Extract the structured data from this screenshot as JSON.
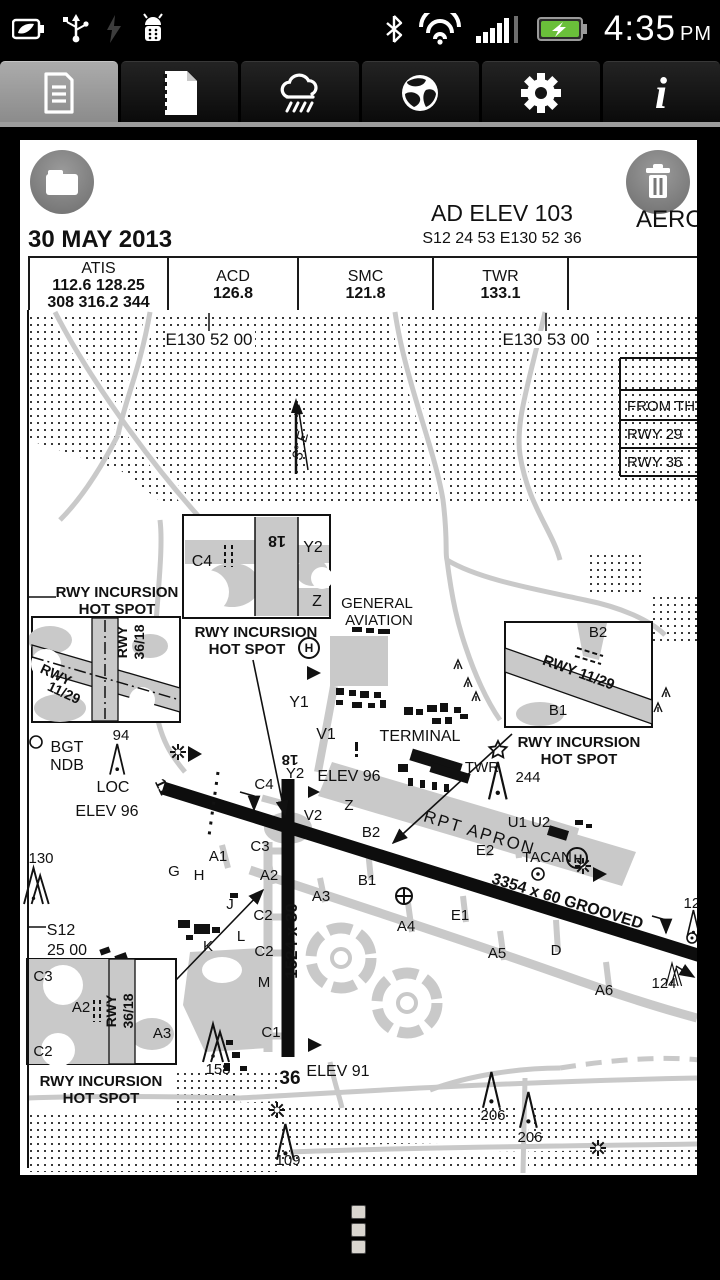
{
  "status_bar": {
    "time": "4:35",
    "meridiem": "PM",
    "left_icons": [
      "battery-saver-leaf-icon",
      "usb-icon",
      "flash-dim-icon",
      "android-debug-icon"
    ],
    "right_icons": [
      "bluetooth-icon",
      "wifi-icon",
      "signal-strength-icon",
      "battery-charging-icon"
    ]
  },
  "tabs": {
    "items": [
      {
        "icon": "document-icon",
        "selected": true
      },
      {
        "icon": "plates-page-icon",
        "selected": false
      },
      {
        "icon": "weather-cloud-icon",
        "selected": false
      },
      {
        "icon": "globe-icon",
        "selected": false
      },
      {
        "icon": "settings-gear-icon",
        "selected": false
      },
      {
        "icon": "info-icon",
        "selected": false
      }
    ]
  },
  "page": {
    "buttons": {
      "folder": "folder-icon",
      "trash": "trash-icon"
    },
    "header": {
      "date": "30 MAY 2013",
      "ad_elev": "AD ELEV 103",
      "ad_coords": "S12 24 53  E130 52 36",
      "title_partial": "AEROD"
    },
    "freq_table": [
      {
        "name": "ATIS",
        "values": [
          "112.6  128.25",
          "308  316.2  344"
        ]
      },
      {
        "name": "ACD",
        "values": [
          "126.8"
        ]
      },
      {
        "name": "SMC",
        "values": [
          "121.8"
        ]
      },
      {
        "name": "TWR",
        "values": [
          "133.1"
        ]
      },
      {
        "name": "",
        "values": []
      }
    ],
    "info_table": {
      "rows": [
        "",
        "FROM TH",
        "RWY 29",
        "RWY 36"
      ]
    },
    "map_labels": [
      {
        "t": "E130 52 00",
        "x": 209,
        "y": 345,
        "s": 17
      },
      {
        "t": "E130 53 00",
        "x": 546,
        "y": 345,
        "s": 17
      },
      {
        "t": "3° E",
        "x": 305,
        "y": 447,
        "s": 15,
        "i": 1,
        "r": -76
      },
      {
        "t": "RWY INCURSION",
        "x": 117,
        "y": 597,
        "s": 15,
        "b": 1
      },
      {
        "t": "HOT SPOT",
        "x": 117,
        "y": 614,
        "s": 15,
        "b": 1
      },
      {
        "t": "RWY INCURSION",
        "x": 256,
        "y": 637,
        "s": 15,
        "b": 1
      },
      {
        "t": "HOT SPOT",
        "x": 247,
        "y": 654,
        "s": 15,
        "b": 1
      },
      {
        "t": "H",
        "x": 309,
        "y": 652,
        "s": 12,
        "b": 1
      },
      {
        "t": "GENERAL",
        "x": 377,
        "y": 608,
        "s": 15
      },
      {
        "t": "AVIATION",
        "x": 379,
        "y": 625,
        "s": 15
      },
      {
        "t": "18",
        "x": 277,
        "y": 536,
        "s": 16,
        "b": 1,
        "r": 180
      },
      {
        "t": "C4",
        "x": 202,
        "y": 566,
        "s": 16
      },
      {
        "t": "Y2",
        "x": 313,
        "y": 552,
        "s": 16
      },
      {
        "t": "Z",
        "x": 317,
        "y": 606,
        "s": 16
      },
      {
        "t": "RWY",
        "x": 127,
        "y": 642,
        "s": 14,
        "b": 1,
        "r": -90
      },
      {
        "t": "36/18",
        "x": 144,
        "y": 642,
        "s": 14,
        "b": 1,
        "r": -90
      },
      {
        "t": "RWY",
        "x": 54,
        "y": 679,
        "s": 14,
        "b": 1,
        "r": 25
      },
      {
        "t": "11/29",
        "x": 62,
        "y": 697,
        "s": 14,
        "b": 1,
        "r": 25
      },
      {
        "t": "BGT",
        "x": 67,
        "y": 752,
        "s": 16
      },
      {
        "t": "NDB",
        "x": 67,
        "y": 770,
        "s": 16
      },
      {
        "t": "94",
        "x": 121,
        "y": 740,
        "s": 15
      },
      {
        "t": "B2",
        "x": 598,
        "y": 637,
        "s": 15
      },
      {
        "t": "RWY 11/29",
        "x": 577,
        "y": 677,
        "s": 15,
        "b": 1,
        "r": 20
      },
      {
        "t": "B1",
        "x": 558,
        "y": 715,
        "s": 15
      },
      {
        "t": "RWY INCURSION",
        "x": 579,
        "y": 747,
        "s": 15,
        "b": 1
      },
      {
        "t": "HOT SPOT",
        "x": 579,
        "y": 764,
        "s": 15,
        "b": 1
      },
      {
        "t": "244",
        "x": 528,
        "y": 782,
        "s": 15
      },
      {
        "t": "Y1",
        "x": 299,
        "y": 707,
        "s": 16
      },
      {
        "t": "V1",
        "x": 326,
        "y": 739,
        "s": 16
      },
      {
        "t": "TERMINAL",
        "x": 420,
        "y": 741,
        "s": 16
      },
      {
        "t": "TWR",
        "x": 482,
        "y": 772,
        "s": 15
      },
      {
        "t": "RPT APRON",
        "x": 478,
        "y": 838,
        "s": 17,
        "r": 17,
        "ls": 2
      },
      {
        "t": "LOC",
        "x": 113,
        "y": 792,
        "s": 16
      },
      {
        "t": "ELEV 96",
        "x": 107,
        "y": 816,
        "s": 16
      },
      {
        "t": "11",
        "x": 158,
        "y": 789,
        "s": 15,
        "b": 1,
        "r": 65
      },
      {
        "t": "18",
        "x": 290,
        "y": 755,
        "s": 15,
        "b": 1,
        "r": 180
      },
      {
        "t": "Y2",
        "x": 295,
        "y": 778,
        "s": 15
      },
      {
        "t": "ELEV 96",
        "x": 349,
        "y": 781,
        "s": 16
      },
      {
        "t": "C4",
        "x": 264,
        "y": 789,
        "s": 15
      },
      {
        "t": "Z",
        "x": 349,
        "y": 810,
        "s": 15
      },
      {
        "t": "V2",
        "x": 313,
        "y": 820,
        "s": 15
      },
      {
        "t": "B2",
        "x": 371,
        "y": 837,
        "s": 15
      },
      {
        "t": "U1 U2",
        "x": 529,
        "y": 827,
        "s": 15
      },
      {
        "t": "E2",
        "x": 485,
        "y": 855,
        "s": 15
      },
      {
        "t": "TACAN",
        "x": 547,
        "y": 862,
        "s": 15
      },
      {
        "t": "H",
        "x": 578,
        "y": 863,
        "s": 12,
        "b": 1
      },
      {
        "t": "3354 x 60 GROOVED",
        "x": 566,
        "y": 906,
        "s": 16,
        "b": 1,
        "r": 17
      },
      {
        "t": "130",
        "x": 41,
        "y": 863,
        "s": 15
      },
      {
        "t": "C3",
        "x": 260,
        "y": 851,
        "s": 15
      },
      {
        "t": "A1",
        "x": 218,
        "y": 861,
        "s": 15
      },
      {
        "t": "G",
        "x": 174,
        "y": 876,
        "s": 15
      },
      {
        "t": "H",
        "x": 199,
        "y": 880,
        "s": 15
      },
      {
        "t": "A2",
        "x": 269,
        "y": 880,
        "s": 15
      },
      {
        "t": "J",
        "x": 230,
        "y": 909,
        "s": 15
      },
      {
        "t": "C2",
        "x": 263,
        "y": 920,
        "s": 15
      },
      {
        "t": "S12",
        "x": 61,
        "y": 935,
        "s": 16
      },
      {
        "t": "25 00",
        "x": 67,
        "y": 955,
        "s": 16
      },
      {
        "t": "K",
        "x": 208,
        "y": 951,
        "s": 15
      },
      {
        "t": "L",
        "x": 241,
        "y": 941,
        "s": 15
      },
      {
        "t": "C2",
        "x": 264,
        "y": 956,
        "s": 15
      },
      {
        "t": "M",
        "x": 264,
        "y": 987,
        "s": 15
      },
      {
        "t": "1524 x 30",
        "x": 297,
        "y": 941,
        "s": 17,
        "b": 1,
        "r": -90
      },
      {
        "t": "A3",
        "x": 321,
        "y": 901,
        "s": 15
      },
      {
        "t": "B1",
        "x": 367,
        "y": 885,
        "s": 15
      },
      {
        "t": "A4",
        "x": 406,
        "y": 931,
        "s": 15
      },
      {
        "t": "E1",
        "x": 460,
        "y": 920,
        "s": 15
      },
      {
        "t": "A5",
        "x": 497,
        "y": 958,
        "s": 15
      },
      {
        "t": "D",
        "x": 556,
        "y": 955,
        "s": 15
      },
      {
        "t": "A6",
        "x": 604,
        "y": 995,
        "s": 15
      },
      {
        "t": "124",
        "x": 664,
        "y": 988,
        "s": 15
      },
      {
        "t": "126",
        "x": 696,
        "y": 908,
        "s": 15
      },
      {
        "t": "GP",
        "x": 707,
        "y": 954,
        "s": 15
      },
      {
        "t": "C1",
        "x": 271,
        "y": 1037,
        "s": 15
      },
      {
        "t": "158",
        "x": 218,
        "y": 1074,
        "s": 15
      },
      {
        "t": "36",
        "x": 290,
        "y": 1084,
        "s": 19,
        "b": 1
      },
      {
        "t": "ELEV 91",
        "x": 338,
        "y": 1076,
        "s": 16
      },
      {
        "t": "C3",
        "x": 43,
        "y": 981,
        "s": 15
      },
      {
        "t": "A2",
        "x": 81,
        "y": 1012,
        "s": 15
      },
      {
        "t": "C2",
        "x": 43,
        "y": 1056,
        "s": 15
      },
      {
        "t": "RWY",
        "x": 116,
        "y": 1011,
        "s": 14,
        "b": 1,
        "r": -90
      },
      {
        "t": "36/18",
        "x": 133,
        "y": 1011,
        "s": 14,
        "b": 1,
        "r": -90
      },
      {
        "t": "A3",
        "x": 162,
        "y": 1038,
        "s": 15
      },
      {
        "t": "RWY INCURSION",
        "x": 101,
        "y": 1086,
        "s": 15,
        "b": 1
      },
      {
        "t": "HOT SPOT",
        "x": 101,
        "y": 1103,
        "s": 15,
        "b": 1
      },
      {
        "t": "206",
        "x": 493,
        "y": 1120,
        "s": 15
      },
      {
        "t": "206",
        "x": 530,
        "y": 1142,
        "s": 15
      },
      {
        "t": "109",
        "x": 288,
        "y": 1165,
        "s": 15
      }
    ]
  }
}
